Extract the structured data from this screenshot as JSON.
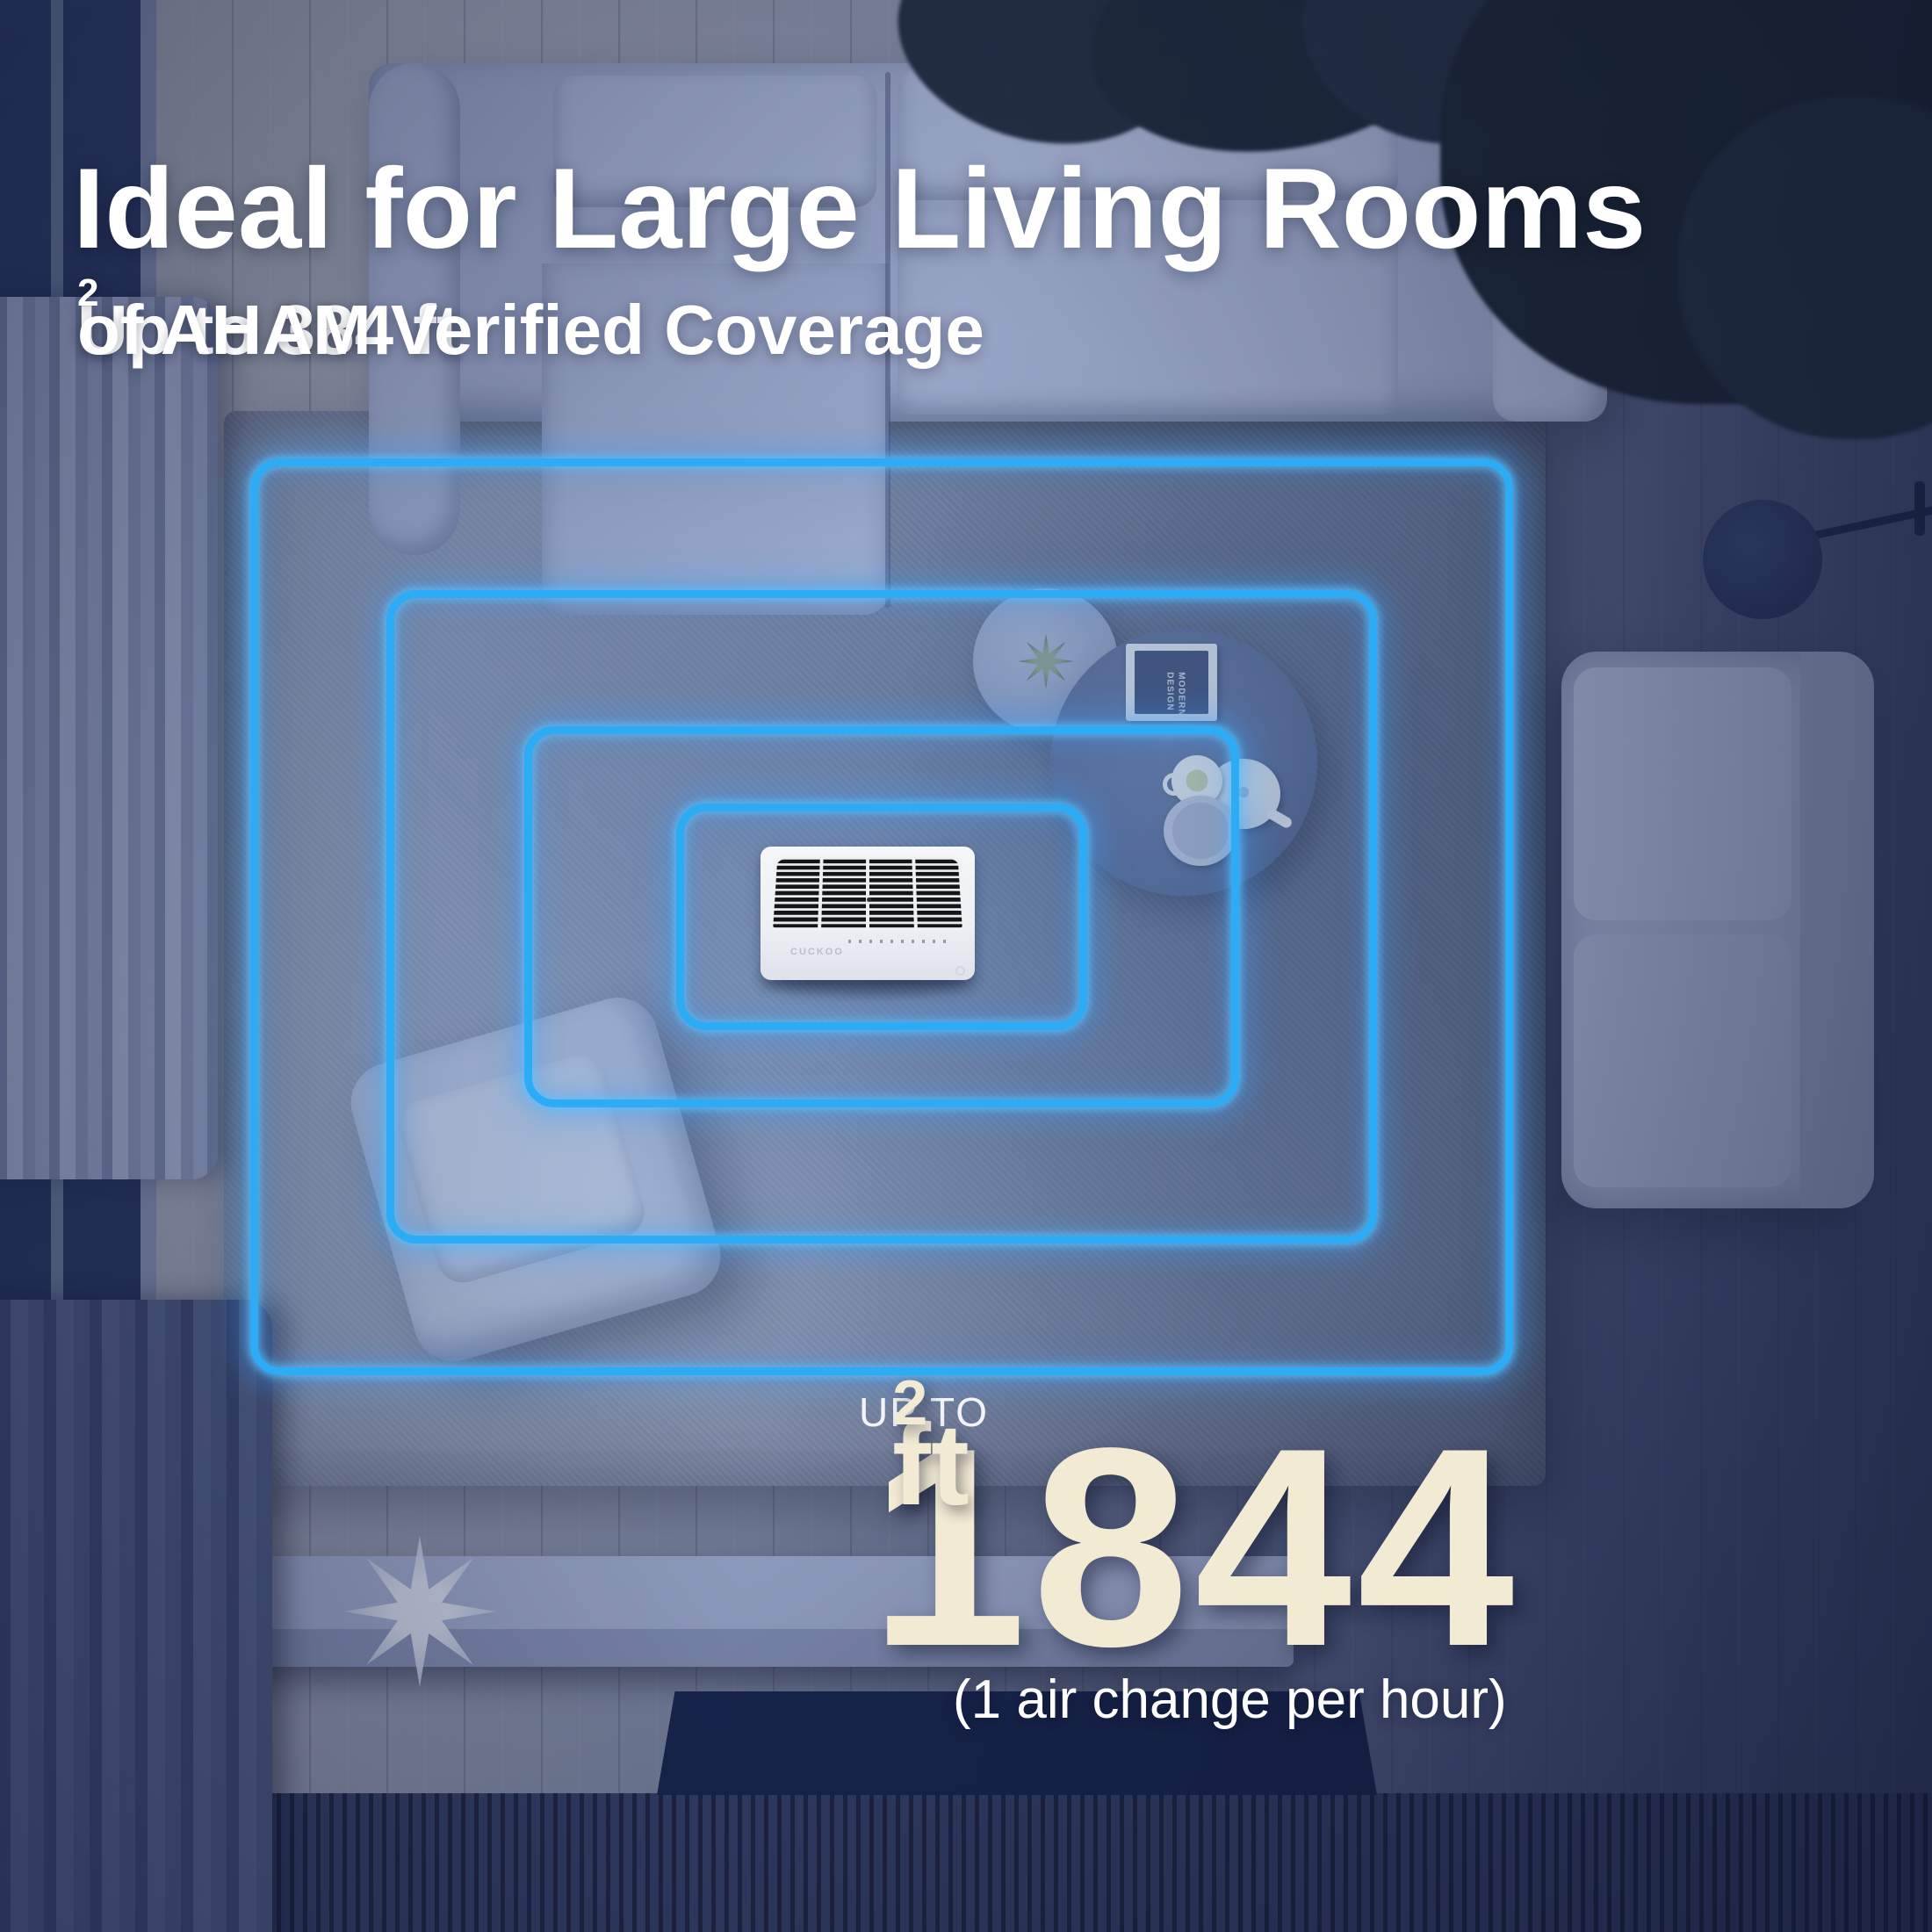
{
  "header": {
    "title": "Ideal for Large Living Rooms",
    "subtitle_prefix": "Up to 384 ft",
    "subtitle_sup": "2",
    "subtitle_suffix": " of AHAM Verified Coverage"
  },
  "coverage_callout": {
    "up_to_label": "UP TO",
    "area_value": "1844",
    "area_unit": "ft",
    "area_unit_sup": "2",
    "note": "(1 air change per hour)"
  },
  "device": {
    "brand": "CUCKOO"
  },
  "coffee_table_book": {
    "line1": "MODERN",
    "line2": "DESIGN"
  },
  "colors": {
    "neon_blue": "#2dacf5",
    "headline_white": "#ffffff",
    "area_cream": "#f3ead4",
    "scene_tint_navy": "#24335c"
  }
}
